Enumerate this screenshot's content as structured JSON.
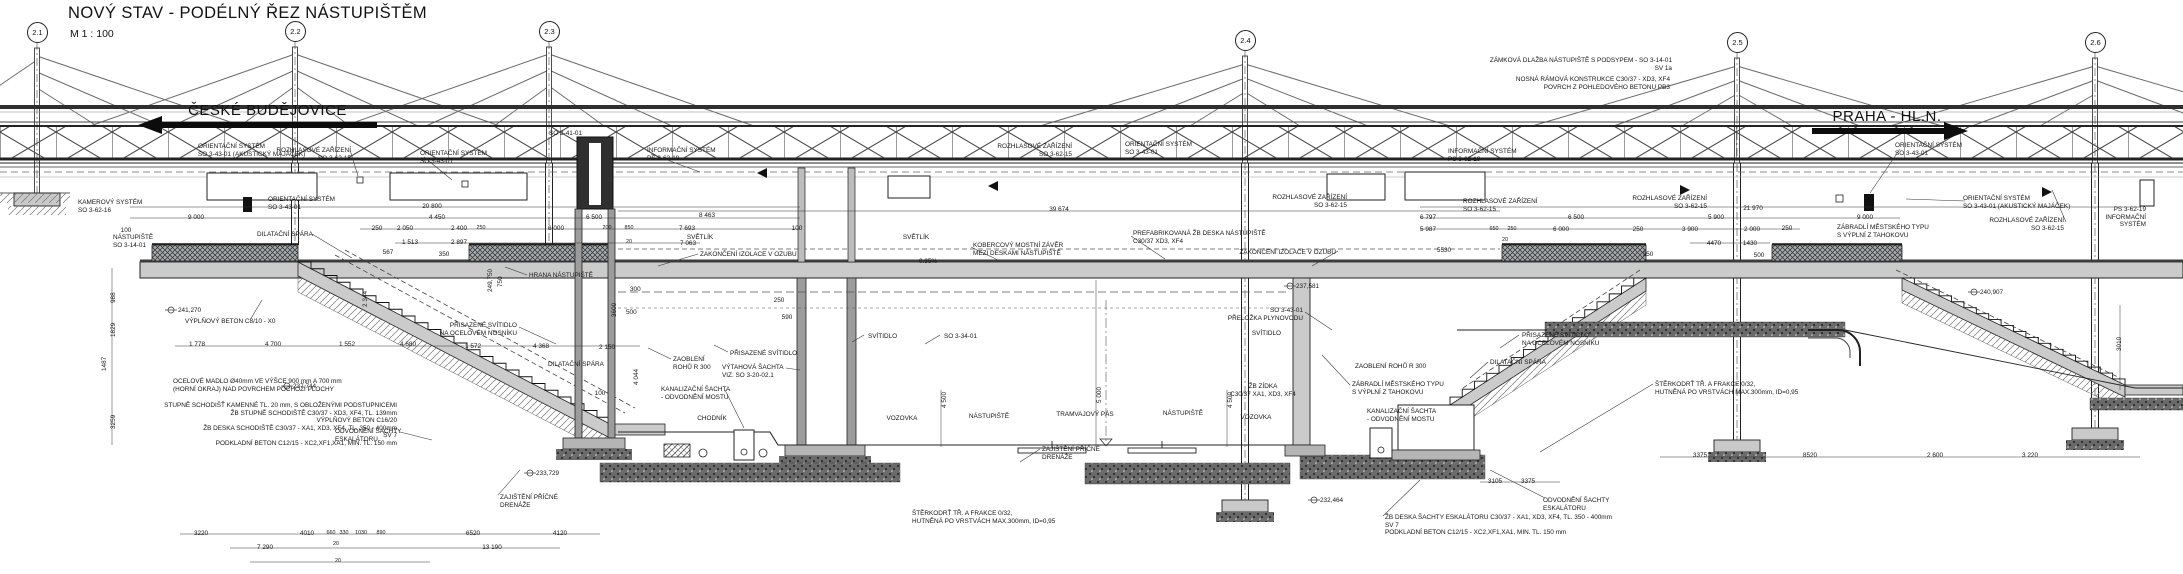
{
  "title": {
    "text": "NOVÝ STAV - PODÉLNÝ ŘEZ NÁSTUPIŠTĚM",
    "scale": "M  1 : 100"
  },
  "directions": {
    "left": "ČESKÉ BUDĚJOVICE",
    "right": "PRAHA - HL.N."
  },
  "colors": {
    "line": "#1c1c1c",
    "concrete": "#cbcbcb",
    "wall": "#9c9c9c",
    "dark": "#2f2f2f",
    "ballast": "#6b6b6b",
    "paper": "#ffffff"
  },
  "pylons": [
    {
      "id": "2.1",
      "x": 37,
      "y": 32
    },
    {
      "id": "2.2",
      "x": 295,
      "y": 31
    },
    {
      "id": "2.3",
      "x": 549,
      "y": 31
    },
    {
      "id": "2.4",
      "x": 1245,
      "y": 40
    },
    {
      "id": "2.5",
      "x": 1737,
      "y": 42
    },
    {
      "id": "2.6",
      "x": 2095,
      "y": 42
    }
  ],
  "annotations": [
    {
      "id": "note-pavement",
      "t": "ZÁMKOVÁ DLAŽBA NÁSTUPIŠTĚ  S PODSYPEM - SO 3-14-01\nSV 1a",
      "x": 1672,
      "y": 57,
      "a": "r"
    },
    {
      "id": "note-frame",
      "t": "NOSNÁ RÁMOVÁ KONSTRUKCE C30/37 - XD3, XF4\nPOVRCH Z POHLEDOVÉHO BETONU PB3",
      "x": 1670,
      "y": 76,
      "a": "r"
    },
    {
      "id": "os-akusticky-left",
      "t": "ORIENTAČNÍ SYSTÉM\nSO 3-43-01 (AKUSTICKÝ MAJÁČEK)",
      "x": 198,
      "y": 143,
      "a": "l"
    },
    {
      "id": "rozhlas-1",
      "t": "ROZHLASOVÉ ZAŘÍZENÍ\nSO 3-62-15",
      "x": 351,
      "y": 147,
      "a": "r"
    },
    {
      "id": "os-2",
      "t": "ORIENTAČNÍ SYSTÉM\nSO 3-43-01",
      "x": 420,
      "y": 150,
      "a": "l"
    },
    {
      "id": "so-3-41-01",
      "t": "SO 3-41-01",
      "x": 549,
      "y": 130,
      "a": "l"
    },
    {
      "id": "kamerovy-system",
      "t": "KAMEROVÝ SYSTÉM\nSO 3-62-16",
      "x": 78,
      "y": 199,
      "a": "l"
    },
    {
      "id": "os-3",
      "t": "ORIENTAČNÍ SYSTÉM\nSO 3-43-01",
      "x": 268,
      "y": 196,
      "a": "l"
    },
    {
      "id": "info-system-1",
      "t": "INFORMAČNÍ SYSTÉM\nPS 3-62-19",
      "x": 647,
      "y": 147,
      "a": "l"
    },
    {
      "id": "rozhlas-2",
      "t": "ROZHLASOVÉ ZAŘÍZENÍ\nSO 3-62-15",
      "x": 1072,
      "y": 143,
      "a": "r"
    },
    {
      "id": "os-4",
      "t": "ORIENTAČNÍ SYSTÉM\nSO 3-43-01",
      "x": 1125,
      "y": 141,
      "a": "l"
    },
    {
      "id": "rozhlas-3",
      "t": "ROZHLASOVÉ ZAŘÍZENÍ\nSO 3-62-15",
      "x": 1347,
      "y": 194,
      "a": "r"
    },
    {
      "id": "info-system-2",
      "t": "INFORMAČNÍ SYSTÉM\nPS 3-62-19",
      "x": 1448,
      "y": 148,
      "a": "l"
    },
    {
      "id": "rozhlas-4",
      "t": "ROZHLASOVÉ ZAŘÍZENÍ\nSO 3-62-15",
      "x": 1463,
      "y": 198,
      "a": "l"
    },
    {
      "id": "rozhlas-5",
      "t": "ROZHLASOVÉ ZAŘÍZENÍ\nSO 3-62-15",
      "x": 1707,
      "y": 195,
      "a": "r"
    },
    {
      "id": "os-5",
      "t": "ORIENTAČNÍ SYSTÉM\nSO 3-43-01",
      "x": 1895,
      "y": 142,
      "a": "l"
    },
    {
      "id": "os-akusticky-right",
      "t": "ORIENTAČNÍ SYSTÉM\nSO 3-43-01 (AKUSTICKÝ MAJÁČEK)",
      "x": 1963,
      "y": 195,
      "a": "l"
    },
    {
      "id": "rozhlas-6",
      "t": "ROZHLASOVÉ ZAŘÍZENÍ\nSO 3-62-15",
      "x": 2064,
      "y": 217,
      "a": "r"
    },
    {
      "id": "info-system-3",
      "t": "PS 3-62-19\nINFORMAČNÍ\nSYSTÉM",
      "x": 2146,
      "y": 206,
      "a": "r"
    },
    {
      "id": "nastupiste-so",
      "t": "NÁSTUPIŠTĚ\nSO 3-14-01",
      "x": 113,
      "y": 234,
      "a": "l"
    },
    {
      "id": "dilatacni-spara-1",
      "t": "DILATAČNÍ SPÁRA",
      "x": 257,
      "y": 231,
      "a": "l"
    },
    {
      "id": "zakonceni-izolace-1",
      "t": "ZAKONČENÍ IZOLACE V OZUBU",
      "x": 700,
      "y": 251,
      "a": "l"
    },
    {
      "id": "hrana-nastupiste",
      "t": "HRANA NÁSTUPIŠTĚ",
      "x": 529,
      "y": 272,
      "a": "l"
    },
    {
      "id": "prisazene-svitidlo-1",
      "t": "PŘISAZENÉ SVÍTIDLO\nNA OCELOVÉM NOSNÍKU",
      "x": 517,
      "y": 322,
      "a": "r"
    },
    {
      "id": "vyplnovy-beton",
      "t": "VÝPLŇOVÝ BETON C8/10 - X0",
      "x": 185,
      "y": 318,
      "a": "l"
    },
    {
      "id": "elev-241-270",
      "t": "241,270",
      "x": 178,
      "y": 307,
      "a": "l"
    },
    {
      "id": "ocelove-madlo",
      "t": "OCELOVÉ MADLO Ø40mm VE VÝŠCE 900 mm A 700 mm\n(HORNÍ OKRAJ) NAD POVRCHEM POCHOZÍ PLOCHY",
      "x": 173,
      "y": 378,
      "a": "l"
    },
    {
      "id": "elev-237-744",
      "t": "237,744",
      "x": 293,
      "y": 383,
      "a": "l"
    },
    {
      "id": "schodiste-notes",
      "t": "STUPNĚ SCHODIŠŤ KAMENNÉ TL. 20 mm, S OBLOŽENÝMI PODSTUPNICEMI\nŽB STUPNĚ SCHODIŠTĚ C30/37 - XD3, XF4,  TL. 139mm\nVÝPLŇOVÝ BETON C16/20\nŽB DESKA SCHODIŠTĚ C30/37 - XA1, XD3, XF4,  TL. 350 - 400mm\nSV 7\nPODKLADNÍ BETON C12/15 - XC2,XF1,XA1, MIN. TL. 150 mm",
      "x": 397,
      "y": 402,
      "a": "r"
    },
    {
      "id": "odvodneni-sachty-1",
      "t": "ODVODNĚNÍ ŠACHTY\nESKALÁTORU",
      "x": 335,
      "y": 428,
      "a": "l"
    },
    {
      "id": "zajisteni-drenaze-1",
      "t": "ZAJIŠTĚNÍ PŘÍČNÉ\nDRENÁŽE",
      "x": 500,
      "y": 494,
      "a": "l"
    },
    {
      "id": "elev-233-729",
      "t": "233,729",
      "x": 536,
      "y": 470,
      "a": "l"
    },
    {
      "id": "dilatacni-spara-2",
      "t": "DILATAČNÍ SPÁRA",
      "x": 548,
      "y": 361,
      "a": "l"
    },
    {
      "id": "dim-100-b",
      "t": "100",
      "x": 600,
      "y": 390,
      "a": "c"
    },
    {
      "id": "dim-4044",
      "t": "4 044",
      "x": 633,
      "y": 369,
      "r": 1
    },
    {
      "id": "zaobleni-rohu-1",
      "t": "ZAOBLENÍ\nROHŮ R 300",
      "x": 673,
      "y": 356,
      "a": "l"
    },
    {
      "id": "vytahova-sachta",
      "t": "VÝTAHOVÁ ŠACHTA\nVIZ. SO 3-20-02.1",
      "x": 722,
      "y": 364,
      "a": "l"
    },
    {
      "id": "kanalizacni-sachta-1",
      "t": "KANALIZAČNÍ ŠACHTA\n- ODVODNĚNÍ MOSTU",
      "x": 661,
      "y": 386,
      "a": "l"
    },
    {
      "id": "chodnik",
      "t": "CHODNÍK",
      "x": 712,
      "y": 415,
      "a": "c"
    },
    {
      "id": "vozovka-1",
      "t": "VOZOVKA",
      "x": 902,
      "y": 415,
      "a": "c"
    },
    {
      "id": "nastupiste-1",
      "t": "NÁSTUPIŠTĚ",
      "x": 989,
      "y": 413,
      "a": "c"
    },
    {
      "id": "tramvajovy-pas",
      "t": "TRAMVAJOVÝ PÁS",
      "x": 1085,
      "y": 411,
      "a": "c"
    },
    {
      "id": "nastupiste-2",
      "t": "NÁSTUPIŠTĚ",
      "x": 1183,
      "y": 410,
      "a": "c"
    },
    {
      "id": "vozovka-2",
      "t": "VOZOVKA",
      "x": 1256,
      "y": 414,
      "a": "c"
    },
    {
      "id": "zb-zidka",
      "t": "ŽB ZÍDKA\nC30/37 XA1, XD3, XF4",
      "x": 1263,
      "y": 383,
      "a": "c"
    },
    {
      "id": "dim-4500-1",
      "t": "4 500",
      "x": 941,
      "y": 392,
      "r": 1
    },
    {
      "id": "dim-5000",
      "t": "5 000",
      "x": 1096,
      "y": 387,
      "r": 1
    },
    {
      "id": "dim-4500-2",
      "t": "4 500",
      "x": 1227,
      "y": 392,
      "r": 1
    },
    {
      "id": "svitidlo-1",
      "t": "SVÍTIDLO",
      "x": 868,
      "y": 333,
      "a": "l"
    },
    {
      "id": "so-3-34-01",
      "t": "SO 3-34-01",
      "x": 944,
      "y": 333,
      "a": "l"
    },
    {
      "id": "prisazene-svitidlo-2",
      "t": "PŘISAZENÉ SVÍTIDLO",
      "x": 730,
      "y": 350,
      "a": "l"
    },
    {
      "id": "spad",
      "t": "0.35%",
      "x": 928,
      "y": 258,
      "a": "c"
    },
    {
      "id": "kobercovy-zaver",
      "t": "KOBERCOVÝ MOSTNÍ ZÁVĚR\nMEZI DESKAMI NÁSTUPIŠTĚ",
      "x": 973,
      "y": 242,
      "a": "l"
    },
    {
      "id": "prefabrikovana-deska",
      "t": "PREFABRIKOVANÁ ŽB DESKA NÁSTUPIŠTĚ\nC30/37 XD3, XF4",
      "x": 1133,
      "y": 230,
      "a": "l"
    },
    {
      "id": "zakonceni-izolace-2",
      "t": "ZAKONČENÍ IZOLACE V OZUBU",
      "x": 1336,
      "y": 249,
      "a": "r"
    },
    {
      "id": "svetlik-1",
      "t": "SVĚTLÍK",
      "x": 700,
      "y": 234,
      "a": "c"
    },
    {
      "id": "svetlik-2",
      "t": "SVĚTLÍK",
      "x": 916,
      "y": 234,
      "a": "c"
    },
    {
      "id": "zaobleni-rohu-2",
      "t": "ZAOBLENÍ ROHŮ R 300",
      "x": 1426,
      "y": 363,
      "a": "r"
    },
    {
      "id": "zabradli-1",
      "t": "ZÁBRADLÍ MĚSTSKÉHO TYPU\nS VÝPLNÍ Z TAHOKOVU",
      "x": 1352,
      "y": 381,
      "a": "l"
    },
    {
      "id": "kanalizacni-sachta-2",
      "t": "KANALIZAČNÍ ŠACHTA\n- ODVODNĚNÍ MOSTU",
      "x": 1367,
      "y": 408,
      "a": "l"
    },
    {
      "id": "prisazene-svitidlo-3",
      "t": "PŘISAZENÉ SVÍTIDLO\nNA OCELOVÉM NOSNÍKU",
      "x": 1522,
      "y": 332,
      "a": "l"
    },
    {
      "id": "dilatacni-spara-3",
      "t": "DILATAČNÍ SPÁRA",
      "x": 1490,
      "y": 359,
      "a": "l"
    },
    {
      "id": "svitidlo-2",
      "t": "SVÍTIDLO",
      "x": 1281,
      "y": 330,
      "a": "r"
    },
    {
      "id": "odvodneni-sachty-2",
      "t": "ODVODNĚNÍ ŠACHTY\nESKALÁTORU",
      "x": 1543,
      "y": 497,
      "a": "l"
    },
    {
      "id": "elev-232-464",
      "t": "232,464",
      "x": 1320,
      "y": 497,
      "a": "l"
    },
    {
      "id": "prelozka-plynovodu",
      "t": "SO 3-43-01\nPŘELOŽKA PLYNOVODU",
      "x": 1303,
      "y": 307,
      "a": "r"
    },
    {
      "id": "elev-237-581",
      "t": "237,581",
      "x": 1296,
      "y": 283,
      "a": "l"
    },
    {
      "id": "zajisteni-drenaze-2",
      "t": "ZAJIŠTĚNÍ PŘÍČNÉ\nDRENÁŽE",
      "x": 1042,
      "y": 446,
      "a": "l"
    },
    {
      "id": "sterkodrt-1",
      "t": "ŠTĚRKODRŤ TŘ. A FRAKCE 0/32,\nHUTNĚNÁ PO VRSTVÁCH MAX.300mm, ID=0,95",
      "x": 912,
      "y": 510,
      "a": "l"
    },
    {
      "id": "sterkodrt-2",
      "t": "ŠTĚRKODRŤ TŘ. A FRAKCE 0/32,\nHUTNĚNÁ PO VRSTVÁCH MAX.300mm, ID=0,95",
      "x": 1655,
      "y": 381,
      "a": "l"
    },
    {
      "id": "zb-deska-sachty",
      "t": "ŽB DESKA ŠACHTY ESKALÁTORU C30/37 - XA1, XD3, XF4,  TL. 350 - 400mm\nSV 7\nPODKLADNÍ BETON C12/15 - XC2,XF1,XA1, MIN. TL. 150 mm",
      "x": 1385,
      "y": 514,
      "a": "l"
    },
    {
      "id": "zabradli-2",
      "t": "ZÁBRADLÍ MĚSTSKÉHO TYPU\nS VÝPLNÍ Z TAHOKOVU",
      "x": 1837,
      "y": 224,
      "a": "l"
    },
    {
      "id": "elev-240-907",
      "t": "240,907",
      "x": 1980,
      "y": 289,
      "a": "l"
    },
    {
      "id": "dim-20800",
      "t": "20 800",
      "x": 432,
      "y": 203,
      "a": "c"
    },
    {
      "id": "dim-9000-l",
      "t": "9 000",
      "x": 196,
      "y": 214,
      "a": "c"
    },
    {
      "id": "dim-100-l",
      "t": "100",
      "x": 126,
      "y": 227,
      "a": "c"
    },
    {
      "id": "dim-4450",
      "t": "4 450",
      "x": 437,
      "y": 214,
      "a": "c"
    },
    {
      "id": "dim-6500-l",
      "t": "6 500",
      "x": 594,
      "y": 214,
      "a": "c"
    },
    {
      "id": "dim-8463",
      "t": "8 463",
      "x": 707,
      "y": 212,
      "a": "c"
    },
    {
      "id": "dim-250-a",
      "t": "250",
      "x": 377,
      "y": 225,
      "a": "c"
    },
    {
      "id": "dim-2050",
      "t": "2 050",
      "x": 405,
      "y": 225,
      "a": "c"
    },
    {
      "id": "dim-2400",
      "t": "2 400",
      "x": 459,
      "y": 225,
      "a": "c"
    },
    {
      "id": "dim-250-b",
      "t": "250",
      "x": 481,
      "y": 225,
      "a": "c",
      "fs": "s"
    },
    {
      "id": "dim-6000-l",
      "t": "6 000",
      "x": 556,
      "y": 225,
      "a": "c"
    },
    {
      "id": "dim-200",
      "t": "200",
      "x": 607,
      "y": 225,
      "a": "c",
      "fs": "s"
    },
    {
      "id": "dim-850",
      "t": "850",
      "x": 629,
      "y": 225,
      "a": "c",
      "fs": "s"
    },
    {
      "id": "dim-7693",
      "t": "7 693",
      "x": 687,
      "y": 225,
      "a": "c"
    },
    {
      "id": "dim-100-c",
      "t": "100",
      "x": 797,
      "y": 225,
      "a": "c"
    },
    {
      "id": "dim-1513",
      "t": "1 513",
      "x": 410,
      "y": 239,
      "a": "c"
    },
    {
      "id": "dim-2897",
      "t": "2 897",
      "x": 459,
      "y": 239,
      "a": "c"
    },
    {
      "id": "dim-350-l",
      "t": "350",
      "x": 444,
      "y": 251,
      "a": "c"
    },
    {
      "id": "dim-567",
      "t": "567",
      "x": 388,
      "y": 249,
      "a": "c"
    },
    {
      "id": "dim-20-a",
      "t": "20",
      "x": 629,
      "y": 239,
      "a": "c",
      "fs": "s"
    },
    {
      "id": "dim-7063",
      "t": "7 063",
      "x": 688,
      "y": 240,
      "a": "c"
    },
    {
      "id": "dim-39674",
      "t": "39 674",
      "x": 1059,
      "y": 206,
      "a": "c"
    },
    {
      "id": "dim-1778",
      "t": "1 778",
      "x": 197,
      "y": 341,
      "a": "c"
    },
    {
      "id": "dim-4700",
      "t": "4 700",
      "x": 273,
      "y": 341,
      "a": "c"
    },
    {
      "id": "dim-1552",
      "t": "1 552",
      "x": 347,
      "y": 341,
      "a": "c"
    },
    {
      "id": "dim-4680",
      "t": "4 680",
      "x": 408,
      "y": 341,
      "a": "c"
    },
    {
      "id": "dim-1572",
      "t": "1 572",
      "x": 473,
      "y": 343,
      "a": "c"
    },
    {
      "id": "dim-4368",
      "t": "4 368",
      "x": 541,
      "y": 343,
      "a": "c"
    },
    {
      "id": "dim-2150",
      "t": "2 150",
      "x": 607,
      "y": 344,
      "a": "c"
    },
    {
      "id": "dim-988",
      "t": "988",
      "x": 110,
      "y": 287,
      "r": 1
    },
    {
      "id": "dim-1829",
      "t": "1829",
      "x": 110,
      "y": 321,
      "r": 1
    },
    {
      "id": "dim-1487",
      "t": "1487",
      "x": 101,
      "y": 355,
      "r": 1
    },
    {
      "id": "dim-3259",
      "t": "3259",
      "x": 110,
      "y": 413,
      "r": 1
    },
    {
      "id": "dim-2344",
      "t": "2 344",
      "x": 362,
      "y": 291,
      "r": 1
    },
    {
      "id": "dim-750",
      "t": "750",
      "x": 497,
      "y": 271,
      "r": 1
    },
    {
      "id": "dim-3600",
      "t": "3600",
      "x": 611,
      "y": 301,
      "r": 1
    },
    {
      "id": "elev-249-750",
      "t": "249,750",
      "x": 487,
      "y": 276,
      "r": 1
    },
    {
      "id": "dim-300",
      "t": "300",
      "x": 630,
      "y": 286,
      "a": "l"
    },
    {
      "id": "dim-500-a",
      "t": "500",
      "x": 626,
      "y": 309,
      "a": "l"
    },
    {
      "id": "dim-250-c",
      "t": "250",
      "x": 779,
      "y": 297,
      "a": "c"
    },
    {
      "id": "dim-590",
      "t": "590",
      "x": 787,
      "y": 314,
      "a": "c"
    },
    {
      "id": "dim-21970",
      "t": "21 970",
      "x": 1753,
      "y": 205,
      "a": "c"
    },
    {
      "id": "dim-6797",
      "t": "6 797",
      "x": 1428,
      "y": 214,
      "a": "c"
    },
    {
      "id": "dim-5987",
      "t": "5 987",
      "x": 1428,
      "y": 226,
      "a": "c"
    },
    {
      "id": "dim-5530",
      "t": "5530",
      "x": 1444,
      "y": 247,
      "a": "c"
    },
    {
      "id": "dim-650",
      "t": "650",
      "x": 1494,
      "y": 226,
      "a": "c",
      "fs": "s"
    },
    {
      "id": "dim-250-d",
      "t": "250",
      "x": 1512,
      "y": 226,
      "a": "c",
      "fs": "s"
    },
    {
      "id": "dim-20-b",
      "t": "20",
      "x": 1505,
      "y": 237,
      "a": "c",
      "fs": "s"
    },
    {
      "id": "dim-6500-r",
      "t": "6 500",
      "x": 1576,
      "y": 214,
      "a": "c"
    },
    {
      "id": "dim-6000-r",
      "t": "6 000",
      "x": 1561,
      "y": 226,
      "a": "c"
    },
    {
      "id": "dim-250-e",
      "t": "250",
      "x": 1638,
      "y": 226,
      "a": "c"
    },
    {
      "id": "dim-5900",
      "t": "5 900",
      "x": 1716,
      "y": 214,
      "a": "c"
    },
    {
      "id": "dim-3900",
      "t": "3 900",
      "x": 1690,
      "y": 226,
      "a": "c"
    },
    {
      "id": "dim-2000",
      "t": "2 000",
      "x": 1752,
      "y": 226,
      "a": "c"
    },
    {
      "id": "dim-4470",
      "t": "4470",
      "x": 1714,
      "y": 240,
      "a": "c"
    },
    {
      "id": "dim-1430",
      "t": "1430",
      "x": 1750,
      "y": 240,
      "a": "c"
    },
    {
      "id": "dim-250-f",
      "t": "250",
      "x": 1787,
      "y": 225,
      "a": "c"
    },
    {
      "id": "dim-9000-r",
      "t": "9 000",
      "x": 1865,
      "y": 214,
      "a": "c"
    },
    {
      "id": "dim-350-r",
      "t": "350",
      "x": 1648,
      "y": 251,
      "a": "c"
    },
    {
      "id": "dim-500-b",
      "t": "500",
      "x": 1759,
      "y": 252,
      "a": "c"
    },
    {
      "id": "dim-3375-a",
      "t": "3375",
      "x": 1700,
      "y": 452,
      "a": "c"
    },
    {
      "id": "dim-8520",
      "t": "8520",
      "x": 1810,
      "y": 452,
      "a": "c"
    },
    {
      "id": "dim-2600",
      "t": "2 600",
      "x": 1935,
      "y": 452,
      "a": "c"
    },
    {
      "id": "dim-3220-r",
      "t": "3 220",
      "x": 2030,
      "y": 452,
      "a": "c"
    },
    {
      "id": "dim-3105",
      "t": "3105",
      "x": 1495,
      "y": 478,
      "a": "c"
    },
    {
      "id": "dim-3375-b",
      "t": "3375",
      "x": 1528,
      "y": 478,
      "a": "c"
    },
    {
      "id": "dim-3010",
      "t": "3010",
      "x": 2116,
      "y": 335,
      "r": 1
    },
    {
      "id": "dim-3220-l",
      "t": "3220",
      "x": 201,
      "y": 530,
      "a": "c"
    },
    {
      "id": "dim-4010",
      "t": "4010",
      "x": 307,
      "y": 530,
      "a": "c"
    },
    {
      "id": "dim-660",
      "t": "660",
      "x": 331,
      "y": 530,
      "a": "c",
      "fs": "s"
    },
    {
      "id": "dim-330",
      "t": "330",
      "x": 344,
      "y": 530,
      "a": "c",
      "fs": "s"
    },
    {
      "id": "dim-1030",
      "t": "1030",
      "x": 361,
      "y": 530,
      "a": "c",
      "fs": "s"
    },
    {
      "id": "dim-890",
      "t": "890",
      "x": 381,
      "y": 530,
      "a": "c",
      "fs": "s"
    },
    {
      "id": "dim-6520",
      "t": "6520",
      "x": 473,
      "y": 530,
      "a": "c"
    },
    {
      "id": "dim-4120",
      "t": "4120",
      "x": 560,
      "y": 530,
      "a": "c"
    },
    {
      "id": "dim-7290",
      "t": "7 290",
      "x": 265,
      "y": 544,
      "a": "c"
    },
    {
      "id": "dim-20-c",
      "t": "20",
      "x": 336,
      "y": 541,
      "a": "c",
      "fs": "s"
    },
    {
      "id": "dim-13190",
      "t": "13 190",
      "x": 492,
      "y": 544,
      "a": "c"
    },
    {
      "id": "dim-20-d",
      "t": "20",
      "x": 338,
      "y": 558,
      "a": "c",
      "fs": "s"
    }
  ]
}
